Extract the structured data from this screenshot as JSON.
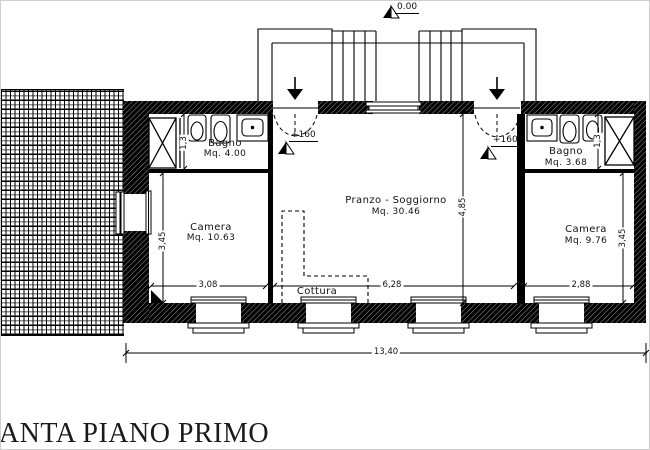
{
  "title": "PIANTA PIANO PRIMO",
  "elevation": {
    "zero": "0.00",
    "entry_left": "+160",
    "entry_right": "+160"
  },
  "rooms": {
    "bagno_left": {
      "name": "Bagno",
      "area": "Mq. 4.00"
    },
    "camera_left": {
      "name": "Camera",
      "area": "Mq. 10.63"
    },
    "pranzo": {
      "name": "Pranzo - Soggiorno",
      "area": "Mq. 30.46"
    },
    "cottura": {
      "name": "Cottura"
    },
    "bagno_right": {
      "name": "Bagno",
      "area": "Mq. 3.68"
    },
    "camera_right": {
      "name": "Camera",
      "area": "Mq. 9.76"
    }
  },
  "dimensions": {
    "camera_left_width": "3,08",
    "pranzo_width": "6,28",
    "camera_right_width": "2,88",
    "total_width": "13,40",
    "camera_left_depth": "3,45",
    "camera_right_depth": "3,45",
    "bagno_left_depth": "1,3",
    "bagno_right_depth": "1,3",
    "pranzo_depth": "4,85"
  }
}
